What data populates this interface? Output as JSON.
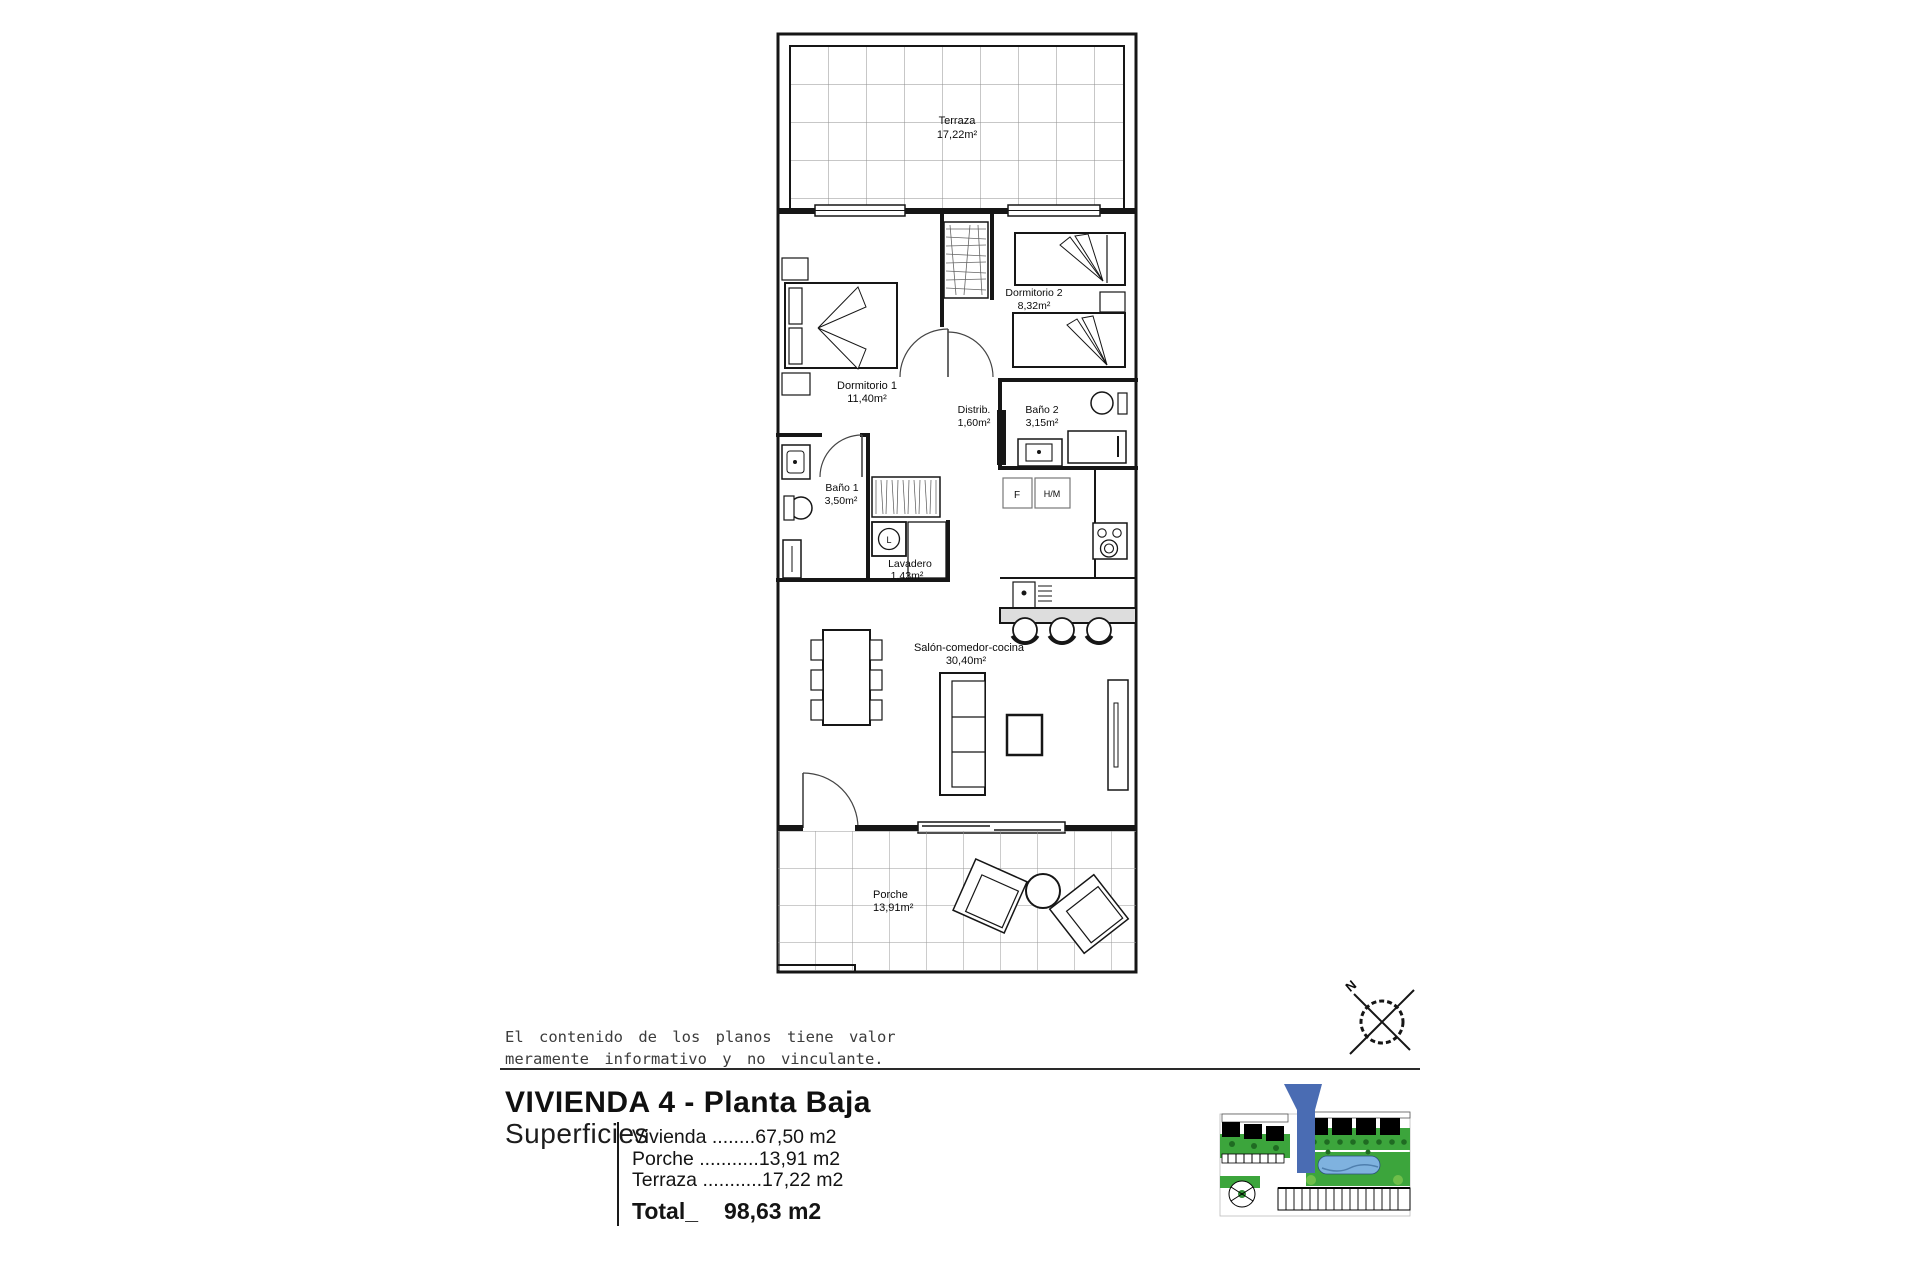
{
  "floor_plan": {
    "rooms": {
      "terraza": {
        "name": "Terraza",
        "area": "17,22m²"
      },
      "dormitorio1": {
        "name": "Dormitorio 1",
        "area": "11,40m²"
      },
      "dormitorio2": {
        "name": "Dormitorio 2",
        "area": "8,32m²"
      },
      "distribuidor": {
        "name": "Distrib.",
        "area": "1,60m²"
      },
      "bano1": {
        "name": "Baño 1",
        "area": "3,50m²"
      },
      "bano2": {
        "name": "Baño 2",
        "area": "3,15m²"
      },
      "lavadero": {
        "name": "Lavadero",
        "area": "1,43m²"
      },
      "salon": {
        "name": "Salón-comedor-cocina",
        "area": "30,40m²"
      },
      "porche": {
        "name": "Porche",
        "area": "13,91m²"
      }
    },
    "appliances": {
      "fridge": "F",
      "oven": "H/M",
      "washer": "L"
    }
  },
  "disclaimer": {
    "line1": "El contenido de los planos tiene valor",
    "line2": "meramente informativo y no vinculante."
  },
  "title": "VIVIENDA 4 - Planta Baja",
  "surfaces": {
    "heading": "Superficies",
    "items": [
      {
        "label": "Vivienda",
        "leader": " ........",
        "value": "67,50 m2"
      },
      {
        "label": "Porche",
        "leader": " ...........",
        "value": "13,91 m2"
      },
      {
        "label": "Terraza",
        "leader": " ...........",
        "value": "17,22 m2"
      }
    ],
    "total_label": "Total_",
    "total_value": "98,63 m2"
  },
  "compass": {
    "north": "N"
  },
  "colors": {
    "marker_blue": "#4a6cb3",
    "pool_blue": "#7fb2df",
    "site_green": "#3ca53c",
    "wall_black": "#161616"
  }
}
